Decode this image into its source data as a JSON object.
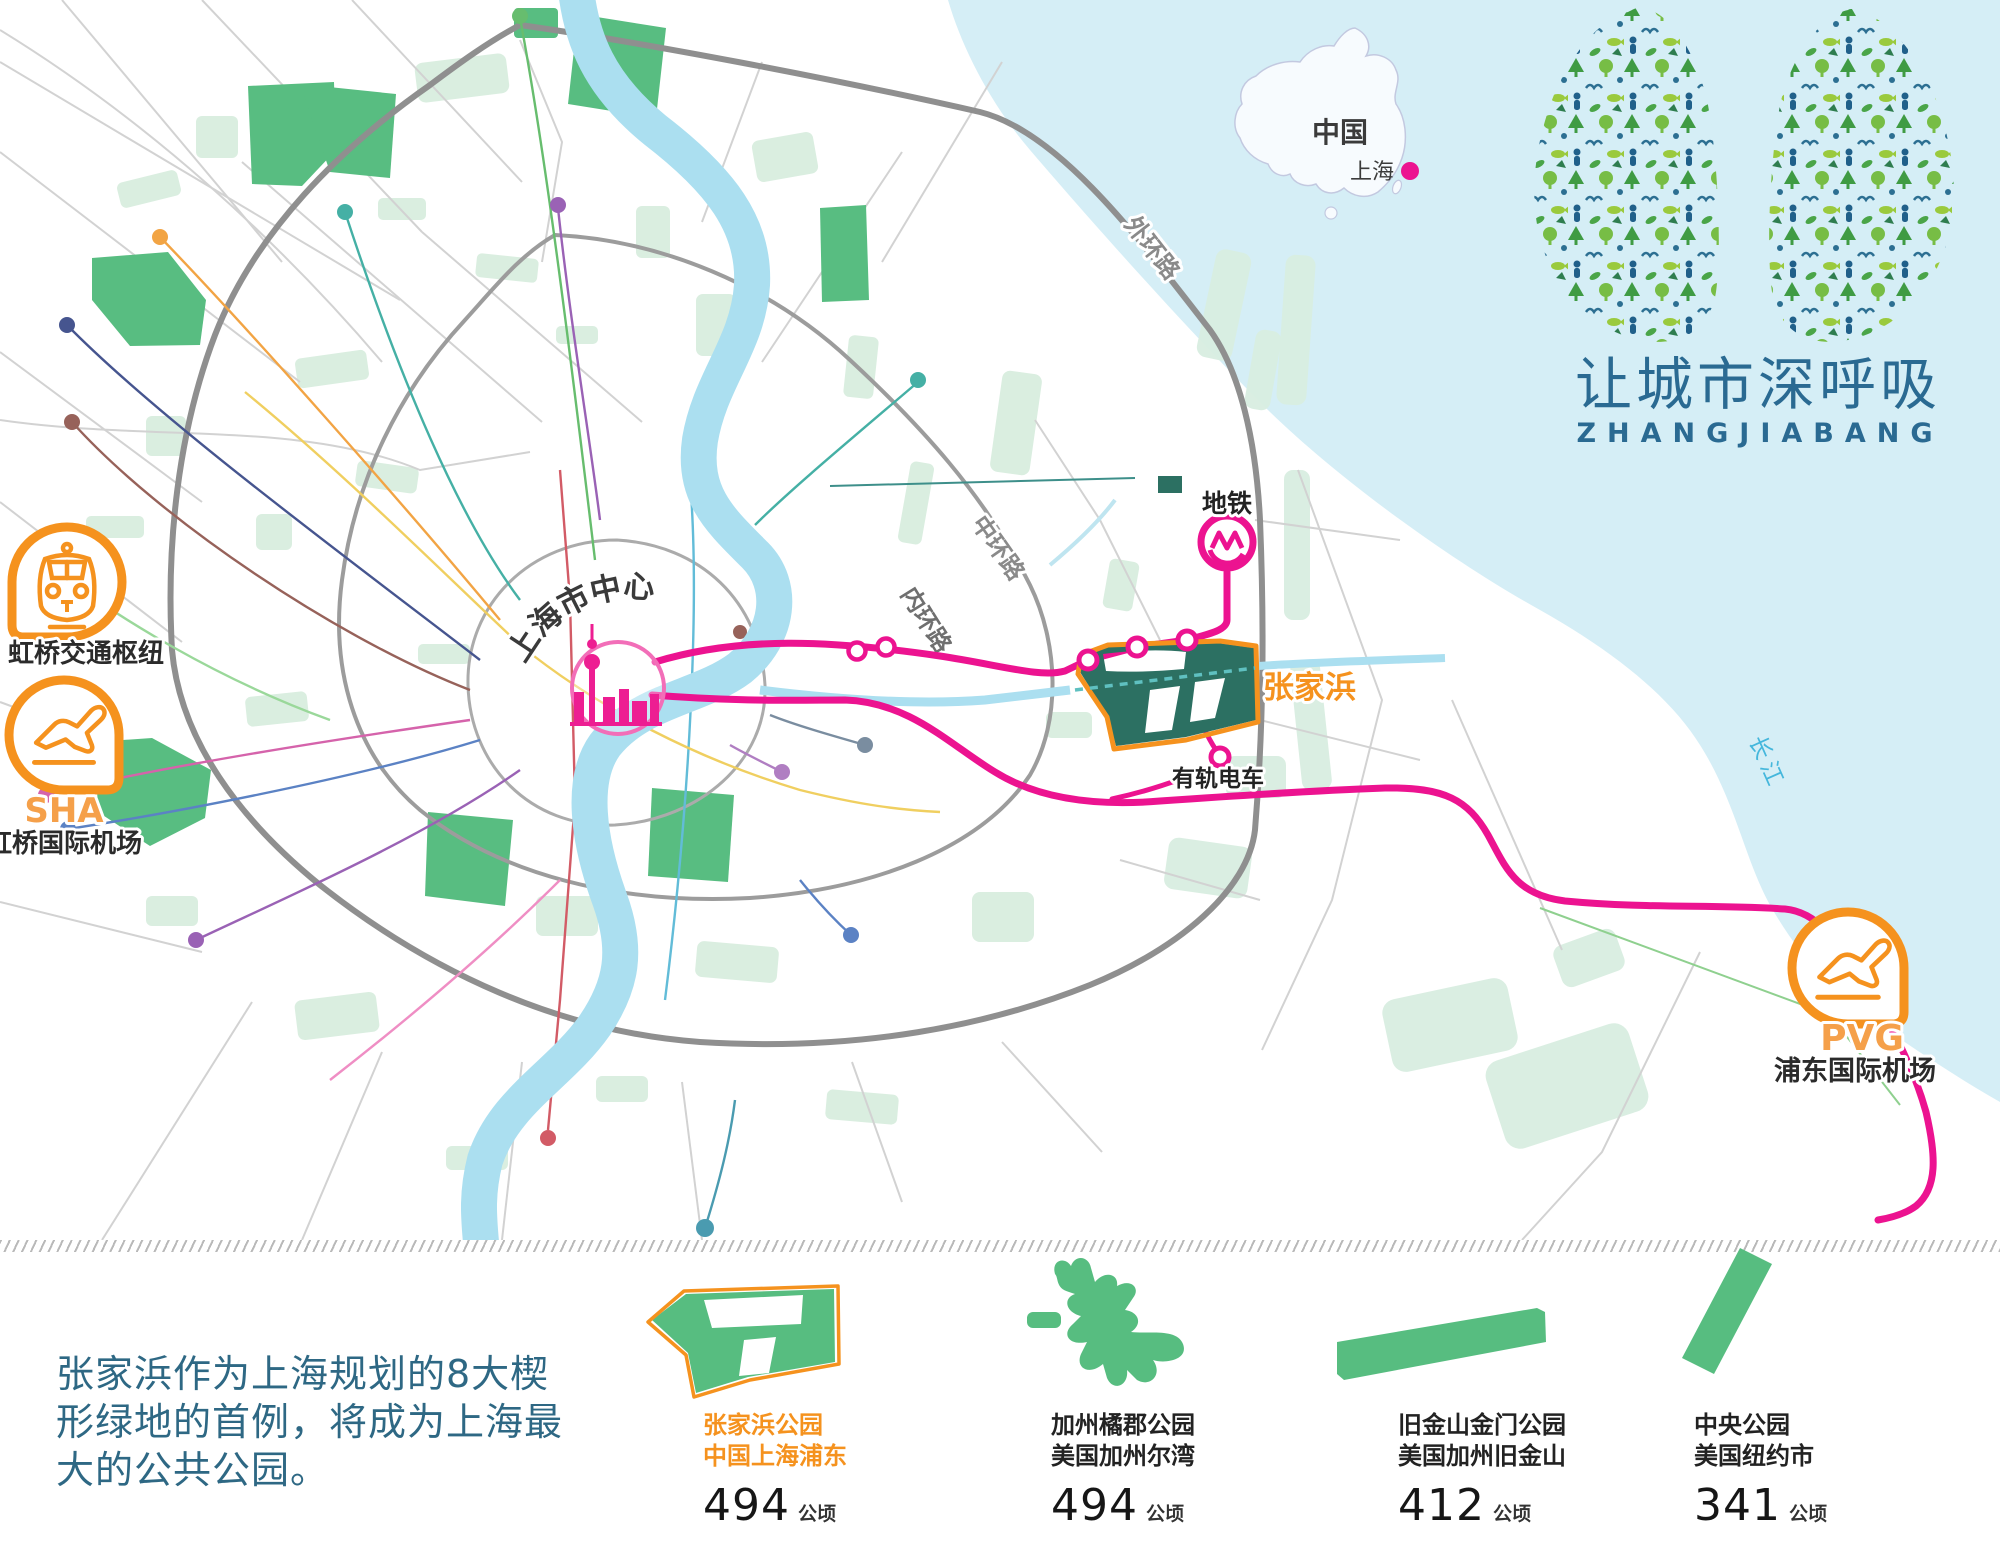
{
  "header": {
    "title_zh": "让城市深呼吸",
    "title_en": "ZHANGJIABANG"
  },
  "inset": {
    "country": "中国",
    "city": "上海"
  },
  "map": {
    "center_label": "上海市中心",
    "park_label": "张家浜",
    "metro_label": "地铁",
    "tram_label": "有轨电车",
    "ring_outer": "外环路",
    "ring_middle": "中环路",
    "ring_inner": "内环路",
    "river_label": "长江"
  },
  "badges": {
    "hub_label": "虹桥交通枢纽",
    "sha_code": "SHA",
    "sha_label": "虹桥国际机场",
    "pvg_code": "PVG",
    "pvg_label": "浦东国际机场"
  },
  "intro_text": "张家浜作为上海规划的8大楔形绿地的首例，将成为上海最大的公共公园。",
  "parks": [
    {
      "name": "张家浜公园",
      "location": "中国上海浦东",
      "area": "494",
      "unit": "公顷"
    },
    {
      "name": "加州橘郡公园",
      "location": "美国加州尔湾",
      "area": "494",
      "unit": "公顷"
    },
    {
      "name": "旧金山金门公园",
      "location": "美国加州旧金山",
      "area": "412",
      "unit": "公顷"
    },
    {
      "name": "中央公园",
      "location": "美国纽约市",
      "area": "341",
      "unit": "公顷"
    }
  ],
  "chart_data": {
    "type": "bar",
    "categories": [
      "张家浜公园 中国上海浦东",
      "加州橘郡公园 美国加州尔湾",
      "旧金山金门公园 美国加州旧金山",
      "中央公园 美国纽约市"
    ],
    "values": [
      494,
      494,
      412,
      341
    ],
    "unit": "公顷",
    "title": ""
  },
  "colors": {
    "accent_orange": "#f5921e",
    "accent_pink": "#ec1390",
    "bright_green": "#57bd80",
    "dark_green": "#2c7062",
    "water_blue": "#d5eef6",
    "river_blue": "#abdff0",
    "title_blue": "#2a6a92",
    "text_teal": "#2e6884"
  }
}
